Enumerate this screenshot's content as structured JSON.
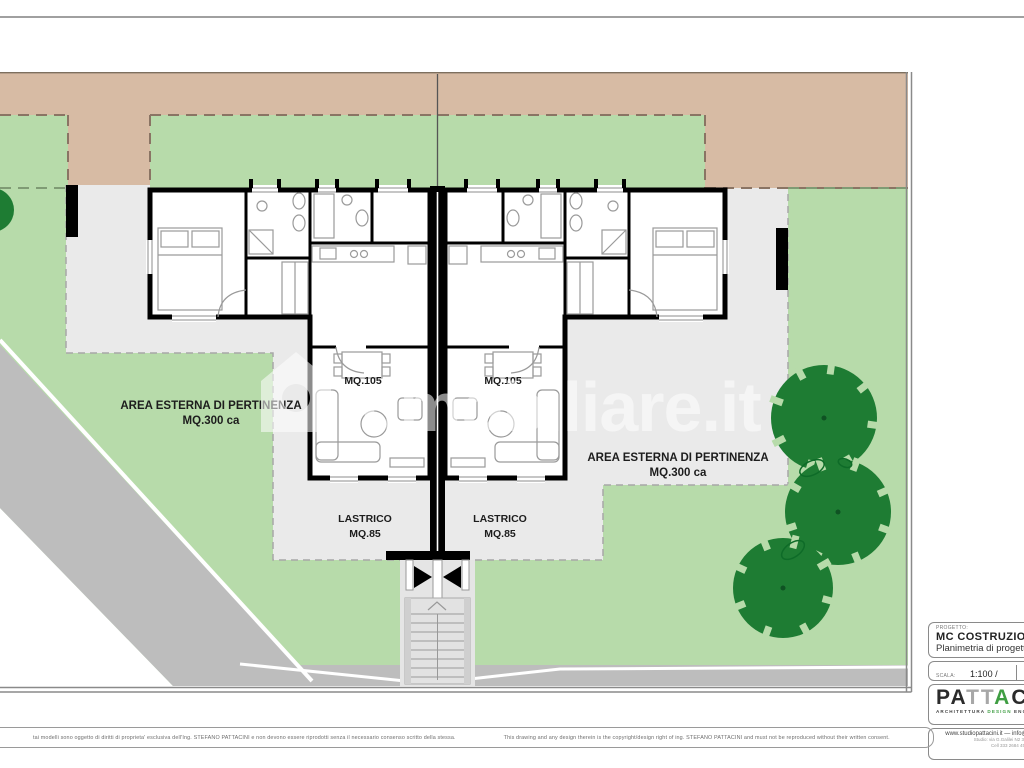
{
  "plan": {
    "area_left": {
      "line1": "AREA ESTERNA DI PERTINENZA",
      "line2": "MQ.300 ca"
    },
    "area_right": {
      "line1": "AREA ESTERNA DI PERTINENZA",
      "line2": "MQ.300 ca"
    },
    "unit_left_area": "MQ.105",
    "unit_right_area": "MQ.105",
    "lastrico_left": {
      "line1": "LASTRICO",
      "line2": "MQ.85"
    },
    "lastrico_right": {
      "line1": "LASTRICO",
      "line2": "MQ.85"
    }
  },
  "watermark": {
    "text": "mmobiliare.it",
    "icon": "house-icon"
  },
  "title_block": {
    "project_label": "PROGETTO:",
    "project_name": "MC COSTRUZIONI",
    "project_subtitle": "Planimetria di progetto",
    "scale_label": "SCALA:",
    "scale_value": "1:100 /",
    "date_label": "DATA:",
    "logo": {
      "part1": "PA",
      "part2": "TT",
      "accent": "A",
      "part3": "CINI",
      "tagline_1": "ARCHITETTURA",
      "tagline_2": "DESIGN",
      "tagline_3": "ENGINEERING"
    },
    "contact": {
      "website": "www.studiopattacini.it",
      "separator": "—",
      "email": "info@studiopattacini.it",
      "address": "Studio: via G.Galilei N2 30022 Por",
      "phone": "Cell 333 2684 45"
    }
  },
  "disclaimer": {
    "italian": "tai modelli sono oggetto di diritti di proprieta' esclusiva dell'Ing. STEFANO PATTACINI e non devono essere riprodotti senza il necessario consenso scritto della stessa.",
    "english": "This drawing and any design therein is the copyright/design right of ing. STEFANO PATTACINI and must not be reproduced without their written consent."
  },
  "colors": {
    "garden_green": "#b7dbaa",
    "tree_green": "#1e7c33",
    "road_tan": "#d7bba4",
    "road_gray": "#bdbdbd",
    "terrace_gray": "#eaeaea",
    "wall_black": "#000000",
    "logo_green": "#3f9e43",
    "watermark": "rgba(255,255,255,0.55)"
  }
}
